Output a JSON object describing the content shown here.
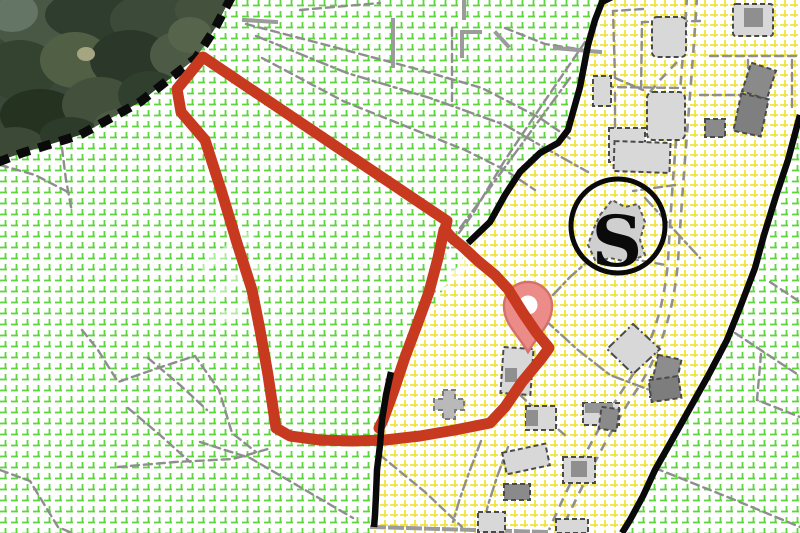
{
  "map": {
    "type": "cadastral-zoning-map",
    "zone_marker": {
      "label": "S"
    },
    "watermark": {
      "text": "VI"
    },
    "colors": {
      "background": "#ffffff",
      "parcel_outline": "#c73a20",
      "pin": "#ec8c88",
      "pin_border": "#d4716d",
      "pin_hole": "#ffffff",
      "green_zone_grid": "#5cd63c",
      "yellow_zone_grid": "#f0e23a",
      "zone_boundary": "#0a0a0a",
      "cadastral_line": "#8e8e8e",
      "building_fill": "#d8d8d8",
      "building_dark_fill": "#8a8a8a",
      "building_outline": "#4a4a4a",
      "forest": "#3a4839"
    }
  }
}
